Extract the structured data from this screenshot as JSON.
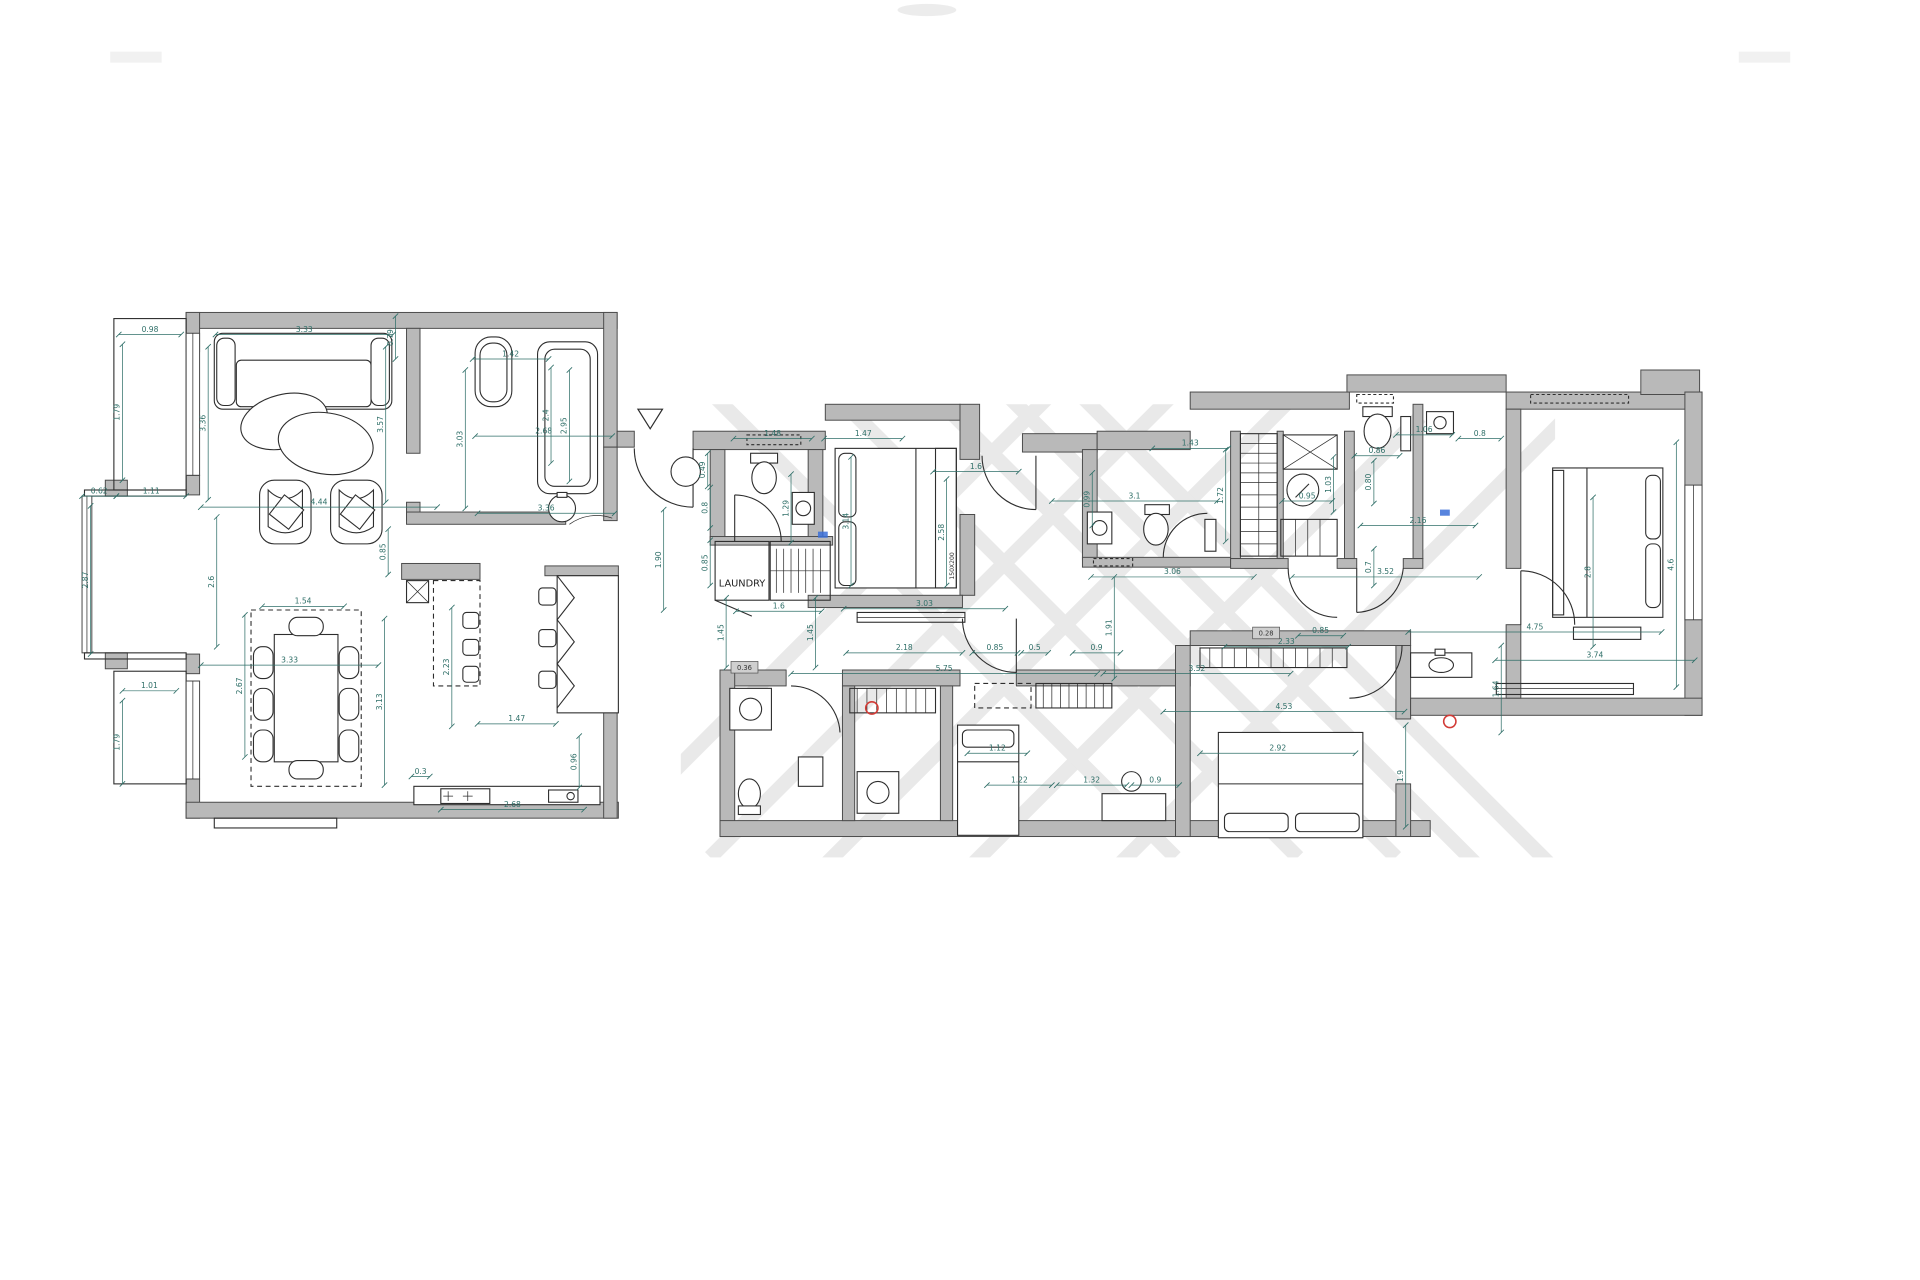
{
  "document": {
    "type": "apartment floor plan",
    "title": "",
    "room_labels": {
      "laundry": "LAUNDRY",
      "bed_size": "150X200"
    }
  },
  "colors": {
    "background": "#ffffff",
    "wall_fill": "#b9b9b9",
    "wall_stroke": "#4a4a4a",
    "furniture_line": "#2e2e2e",
    "dimension": "#2f6f68",
    "watermark": "#e7e7e7",
    "marker_red": "#d23b36",
    "marker_blue": "#3a6fd8"
  },
  "dimensions": [
    {
      "t": "0.98",
      "x1": 97,
      "y1": 273,
      "x2": 148,
      "y2": 273
    },
    {
      "t": "1.79",
      "x1": 100,
      "y1": 281,
      "x2": 100,
      "y2": 392
    },
    {
      "t": "3.33",
      "x1": 176,
      "y1": 273,
      "x2": 321,
      "y2": 273
    },
    {
      "t": "0.79",
      "x1": 323,
      "y1": 258,
      "x2": 323,
      "y2": 293
    },
    {
      "t": "3.57",
      "x1": 315,
      "y1": 283,
      "x2": 315,
      "y2": 410
    },
    {
      "t": "3.36",
      "x1": 170,
      "y1": 283,
      "x2": 170,
      "y2": 408
    },
    {
      "t": "1.42",
      "x1": 386,
      "y1": 293,
      "x2": 448,
      "y2": 293
    },
    {
      "t": "3.03",
      "x1": 380,
      "y1": 302,
      "x2": 380,
      "y2": 415
    },
    {
      "t": "2.68",
      "x1": 388,
      "y1": 356,
      "x2": 500,
      "y2": 356
    },
    {
      "t": "2.4",
      "x1": 450,
      "y1": 300,
      "x2": 450,
      "y2": 378
    },
    {
      "t": "2.95",
      "x1": 465,
      "y1": 302,
      "x2": 465,
      "y2": 393
    },
    {
      "t": "3.36",
      "x1": 390,
      "y1": 419,
      "x2": 502,
      "y2": 419
    },
    {
      "t": "0.62",
      "x1": 67,
      "y1": 405,
      "x2": 95,
      "y2": 405
    },
    {
      "t": "1.11",
      "x1": 95,
      "y1": 405,
      "x2": 152,
      "y2": 405
    },
    {
      "t": "2.87",
      "x1": 74,
      "y1": 413,
      "x2": 74,
      "y2": 534
    },
    {
      "t": "4.44",
      "x1": 164,
      "y1": 414,
      "x2": 357,
      "y2": 414
    },
    {
      "t": "2.6",
      "x1": 177,
      "y1": 422,
      "x2": 177,
      "y2": 528
    },
    {
      "t": "1.54",
      "x1": 214,
      "y1": 495,
      "x2": 281,
      "y2": 495
    },
    {
      "t": "3.33",
      "x1": 164,
      "y1": 543,
      "x2": 309,
      "y2": 543
    },
    {
      "t": "2.67",
      "x1": 200,
      "y1": 502,
      "x2": 200,
      "y2": 618
    },
    {
      "t": "1.01",
      "x1": 100,
      "y1": 564,
      "x2": 144,
      "y2": 564
    },
    {
      "t": "1.79",
      "x1": 100,
      "y1": 572,
      "x2": 100,
      "y2": 640
    },
    {
      "t": "0.85",
      "x1": 317,
      "y1": 432,
      "x2": 317,
      "y2": 469
    },
    {
      "t": "2.23",
      "x1": 369,
      "y1": 496,
      "x2": 369,
      "y2": 593
    },
    {
      "t": "3.13",
      "x1": 314,
      "y1": 505,
      "x2": 314,
      "y2": 641
    },
    {
      "t": "1.47",
      "x1": 390,
      "y1": 591,
      "x2": 454,
      "y2": 591
    },
    {
      "t": "0.3",
      "x1": 336,
      "y1": 634,
      "x2": 351,
      "y2": 634
    },
    {
      "t": "2.68",
      "x1": 360,
      "y1": 661,
      "x2": 477,
      "y2": 661
    },
    {
      "t": "0.96",
      "x1": 473,
      "y1": 601,
      "x2": 473,
      "y2": 643
    },
    {
      "t": "1.90",
      "x1": 542,
      "y1": 416,
      "x2": 542,
      "y2": 498
    },
    {
      "t": "0.49",
      "x1": 578,
      "y1": 370,
      "x2": 578,
      "y2": 397
    },
    {
      "t": "1.48",
      "x1": 599,
      "y1": 358,
      "x2": 663,
      "y2": 358
    },
    {
      "t": "1.29",
      "x1": 646,
      "y1": 387,
      "x2": 646,
      "y2": 443
    },
    {
      "t": "0.8",
      "x1": 580,
      "y1": 398,
      "x2": 580,
      "y2": 431
    },
    {
      "t": "0.85",
      "x1": 580,
      "y1": 441,
      "x2": 580,
      "y2": 478
    },
    {
      "t": "1.6",
      "x1": 601,
      "y1": 499,
      "x2": 671,
      "y2": 499
    },
    {
      "t": "1.45",
      "x1": 593,
      "y1": 488,
      "x2": 593,
      "y2": 545
    },
    {
      "t": "1.45",
      "x1": 666,
      "y1": 488,
      "x2": 666,
      "y2": 545
    },
    {
      "t": "1.47",
      "x1": 673,
      "y1": 358,
      "x2": 737,
      "y2": 358
    },
    {
      "t": "1.6",
      "x1": 762,
      "y1": 385,
      "x2": 832,
      "y2": 385
    },
    {
      "t": "3.14",
      "x1": 695,
      "y1": 373,
      "x2": 695,
      "y2": 478
    },
    {
      "t": "2.58",
      "x1": 773,
      "y1": 391,
      "x2": 773,
      "y2": 478
    },
    {
      "t": "0.99",
      "x1": 892,
      "y1": 386,
      "x2": 892,
      "y2": 429
    },
    {
      "t": "3.03",
      "x1": 689,
      "y1": 497,
      "x2": 821,
      "y2": 497
    },
    {
      "t": "2.18",
      "x1": 691,
      "y1": 533,
      "x2": 786,
      "y2": 533
    },
    {
      "t": "5.75",
      "x1": 646,
      "y1": 550,
      "x2": 896,
      "y2": 550
    },
    {
      "t": "0.85",
      "x1": 794,
      "y1": 533,
      "x2": 831,
      "y2": 533
    },
    {
      "t": "0.5",
      "x1": 834,
      "y1": 533,
      "x2": 856,
      "y2": 533
    },
    {
      "t": "0.9",
      "x1": 876,
      "y1": 533,
      "x2": 915,
      "y2": 533
    },
    {
      "t": "1.91",
      "x1": 910,
      "y1": 471,
      "x2": 910,
      "y2": 554
    },
    {
      "t": "3.06",
      "x1": 891,
      "y1": 471,
      "x2": 1024,
      "y2": 471
    },
    {
      "t": "3.52",
      "x1": 1055,
      "y1": 471,
      "x2": 1208,
      "y2": 471
    },
    {
      "t": "3.52",
      "x1": 901,
      "y1": 550,
      "x2": 1054,
      "y2": 550
    },
    {
      "t": "1.43",
      "x1": 941,
      "y1": 366,
      "x2": 1003,
      "y2": 366
    },
    {
      "t": "3.1",
      "x1": 859,
      "y1": 409,
      "x2": 994,
      "y2": 409
    },
    {
      "t": "1.72",
      "x1": 1001,
      "y1": 367,
      "x2": 1001,
      "y2": 442
    },
    {
      "t": "0.95",
      "x1": 1047,
      "y1": 409,
      "x2": 1088,
      "y2": 409
    },
    {
      "t": "1.03",
      "x1": 1089,
      "y1": 373,
      "x2": 1089,
      "y2": 418
    },
    {
      "t": "0.86",
      "x1": 1106,
      "y1": 372,
      "x2": 1143,
      "y2": 372
    },
    {
      "t": "0.80",
      "x1": 1122,
      "y1": 376,
      "x2": 1122,
      "y2": 411
    },
    {
      "t": "0.7",
      "x1": 1122,
      "y1": 448,
      "x2": 1122,
      "y2": 478
    },
    {
      "t": "2.16",
      "x1": 1111,
      "y1": 429,
      "x2": 1205,
      "y2": 429
    },
    {
      "t": "1.06",
      "x1": 1140,
      "y1": 355,
      "x2": 1186,
      "y2": 355
    },
    {
      "t": "0.8",
      "x1": 1191,
      "y1": 358,
      "x2": 1226,
      "y2": 358
    },
    {
      "t": "2.8",
      "x1": 1301,
      "y1": 406,
      "x2": 1301,
      "y2": 528
    },
    {
      "t": "4.75",
      "x1": 1150,
      "y1": 516,
      "x2": 1357,
      "y2": 516
    },
    {
      "t": "3.74",
      "x1": 1221,
      "y1": 539,
      "x2": 1384,
      "y2": 539
    },
    {
      "t": "4.6",
      "x1": 1369,
      "y1": 361,
      "x2": 1369,
      "y2": 561
    },
    {
      "t": "1.64",
      "x1": 1226,
      "y1": 527,
      "x2": 1226,
      "y2": 598
    },
    {
      "t": "1.22",
      "x1": 806,
      "y1": 641,
      "x2": 859,
      "y2": 641
    },
    {
      "t": "1.32",
      "x1": 863,
      "y1": 641,
      "x2": 920,
      "y2": 641
    },
    {
      "t": "0.9",
      "x1": 924,
      "y1": 641,
      "x2": 963,
      "y2": 641
    },
    {
      "t": "1.12",
      "x1": 790,
      "y1": 615,
      "x2": 839,
      "y2": 615
    },
    {
      "t": "4.53",
      "x1": 950,
      "y1": 581,
      "x2": 1147,
      "y2": 581
    },
    {
      "t": "2.33",
      "x1": 1000,
      "y1": 528,
      "x2": 1101,
      "y2": 528
    },
    {
      "t": "2.92",
      "x1": 980,
      "y1": 615,
      "x2": 1107,
      "y2": 615
    },
    {
      "t": "1.9",
      "x1": 1148,
      "y1": 592,
      "x2": 1148,
      "y2": 675
    },
    {
      "t": "0.85",
      "x1": 1060,
      "y1": 519,
      "x2": 1097,
      "y2": 519
    }
  ],
  "labels": [
    {
      "t": "LAUNDRY",
      "x": 606,
      "y": 479,
      "size": 8,
      "rot": 0,
      "box": false,
      "color": "#222222"
    },
    {
      "t": "150X200",
      "x": 779,
      "y": 462,
      "size": 5,
      "rot": -90,
      "box": false,
      "color": "#333333"
    },
    {
      "t": "0.36",
      "x": 608,
      "y": 547,
      "size": 5.5,
      "rot": 0,
      "box": true,
      "color": "#333333"
    },
    {
      "t": "0.28",
      "x": 1034,
      "y": 519,
      "size": 5.5,
      "rot": 0,
      "box": true,
      "color": "#333333"
    }
  ],
  "markers": {
    "red_circles": [
      {
        "x": 712,
        "y": 578,
        "r": 5
      },
      {
        "x": 1184,
        "y": 589,
        "r": 5
      }
    ],
    "blue_ticks": [
      {
        "x": 668,
        "y": 434
      },
      {
        "x": 1176,
        "y": 416
      }
    ]
  }
}
